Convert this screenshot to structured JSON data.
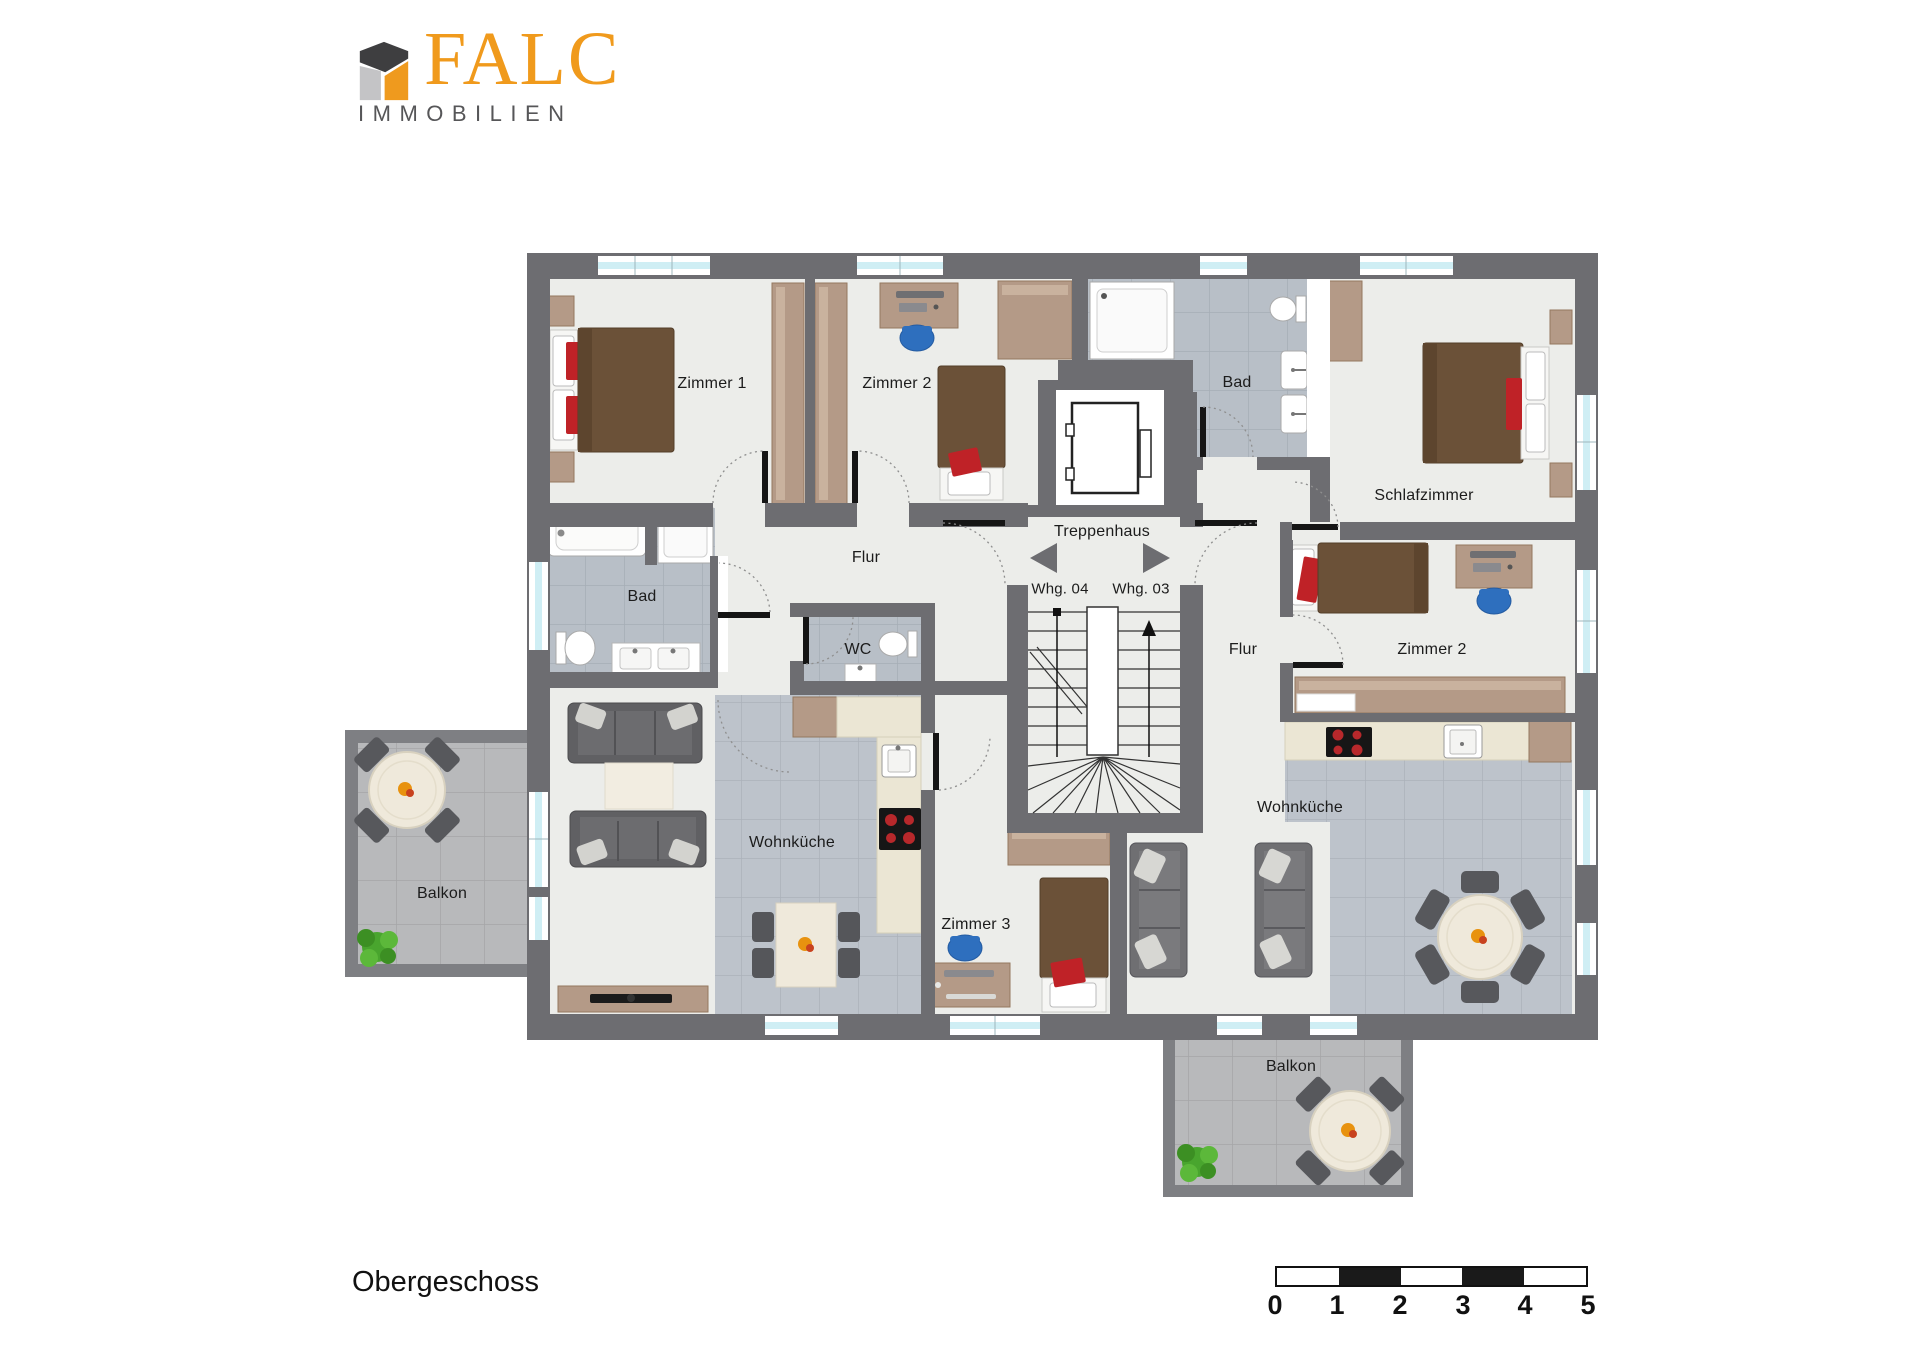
{
  "logo": {
    "brand": "FALC",
    "subtitle": "IMMOBILIEN"
  },
  "floor_label": "Obergeschoss",
  "labels": {
    "zimmer1_left": "Zimmer 1",
    "zimmer2_left": "Zimmer 2",
    "bad_right": "Bad",
    "schlafzimmer": "Schlafzimmer",
    "treppenhaus": "Treppenhaus",
    "whg04": "Whg. 04",
    "whg03": "Whg. 03",
    "flur_left": "Flur",
    "bad_left": "Bad",
    "wc": "WC",
    "flur_right": "Flur",
    "zimmer2_right": "Zimmer 2",
    "wohnkueche_left": "Wohnküche",
    "zimmer3": "Zimmer 3",
    "wohnkueche_right": "Wohnküche",
    "balkon_left": "Balkon",
    "balkon_bottom": "Balkon"
  },
  "scalebar": {
    "ticks": [
      "0",
      "1",
      "2",
      "3",
      "4",
      "5"
    ]
  },
  "colors": {
    "brand_orange": "#ef9a1e",
    "wall_gray": "#6d6d71",
    "window_glass": "#cfeef4",
    "accent_red": "#bf2227",
    "wood": "#b49a87",
    "tile_gray": "#b9c0c8"
  }
}
